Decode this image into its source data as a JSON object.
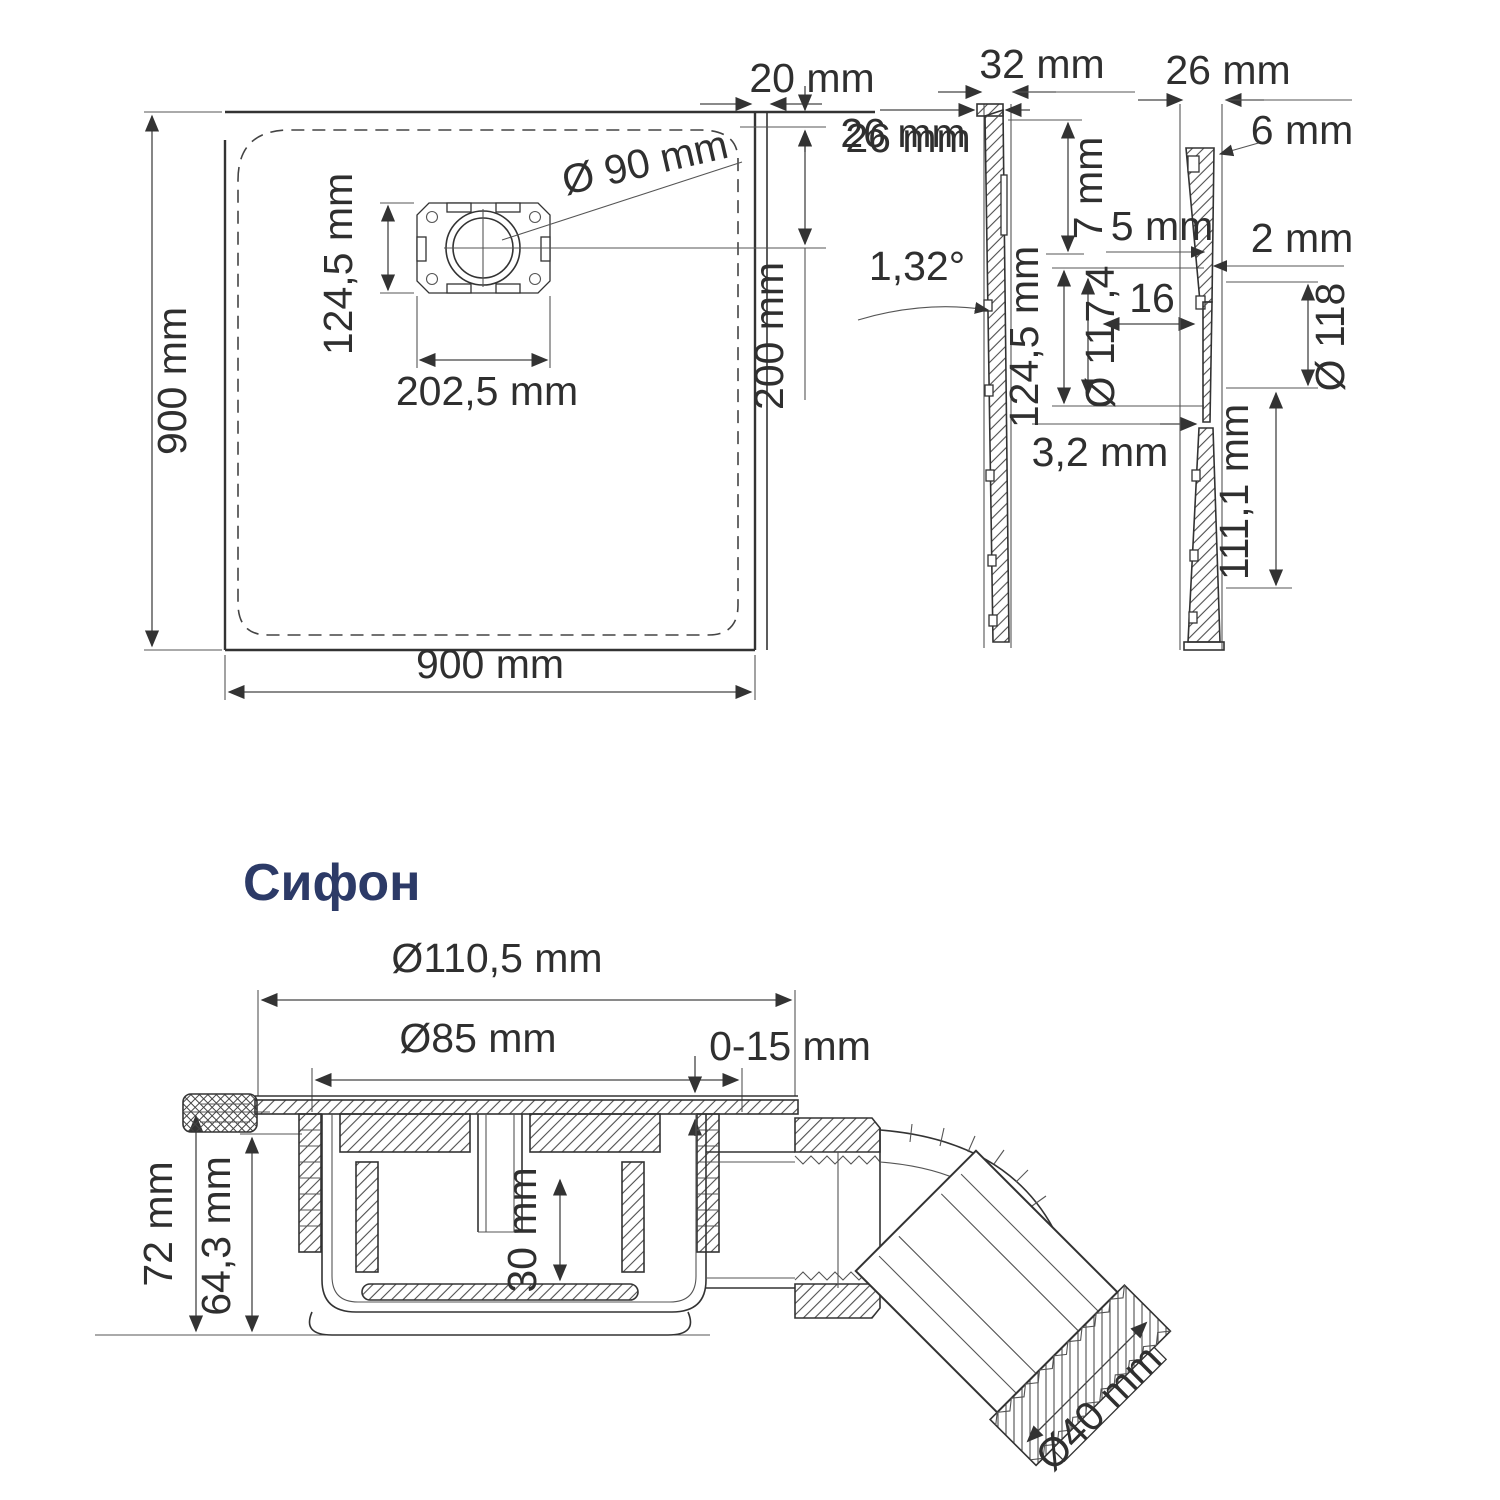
{
  "colors": {
    "line": "#333333",
    "text": "#2f2f2f",
    "heading": "#2c3a67",
    "background": "#ffffff"
  },
  "plan": {
    "height_label": "900 mm",
    "width_label": "900 mm",
    "drain_dia": "Ø 90 mm",
    "drain_h": "124,5 mm",
    "drain_w": "202,5 mm",
    "top_gap": "20 mm",
    "top_inset": "26 mm",
    "center_offset": "200 mm"
  },
  "sections": {
    "left": {
      "top_width": "32 mm",
      "edge": "26 mm",
      "lip": "7 mm",
      "angle": "1,32°",
      "thickness": "3,2 mm"
    },
    "middle": {
      "span": "124,5 mm",
      "inner_dia": "Ø 117,4",
      "gap": "16"
    },
    "right": {
      "top_width": "26 mm",
      "edge": "6 mm",
      "step_left": "5 mm",
      "step_right": "2 mm",
      "outer_dia": "Ø 118",
      "depth": "111,1 mm"
    }
  },
  "siphon": {
    "heading": "Сифон",
    "flange_dia": "Ø110,5 mm",
    "body_dia": "Ø85 mm",
    "adjust": "0-15 mm",
    "total_h": "72 mm",
    "inner_h": "64,3 mm",
    "cup_depth": "30 mm",
    "outlet_dia": "Ø40 mm"
  }
}
